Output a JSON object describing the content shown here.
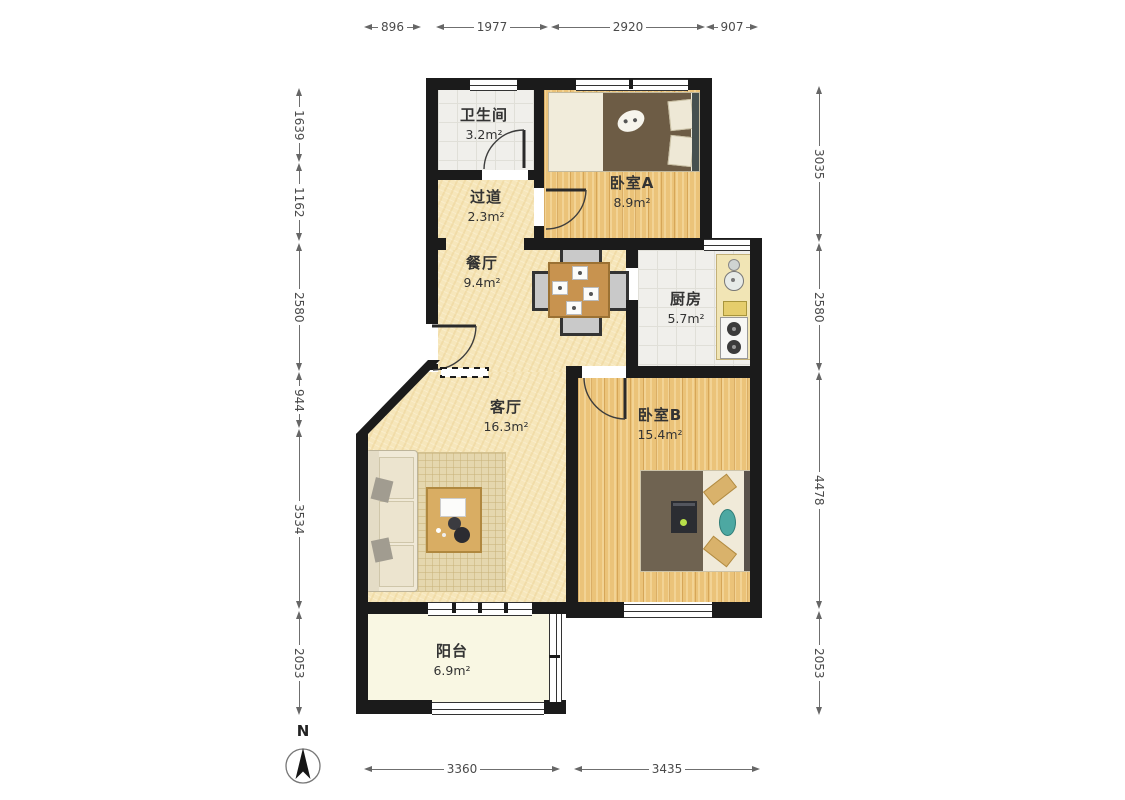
{
  "compass": {
    "label": "N"
  },
  "rooms": [
    {
      "name": "卫生间",
      "area": "3.2m²"
    },
    {
      "name": "过道",
      "area": "2.3m²"
    },
    {
      "name": "卧室A",
      "area": "8.9m²"
    },
    {
      "name": "餐厅",
      "area": "9.4m²"
    },
    {
      "name": "厨房",
      "area": "5.7m²"
    },
    {
      "name": "客厅",
      "area": "16.3m²"
    },
    {
      "name": "卧室B",
      "area": "15.4m²"
    },
    {
      "name": "阳台",
      "area": "6.9m²"
    }
  ],
  "dimensions": {
    "top": [
      "896",
      "1977",
      "2920",
      "907"
    ],
    "left": [
      "1639",
      "1162",
      "2580",
      "944",
      "3534",
      "2053"
    ],
    "right": [
      "3035",
      "2580",
      "4478",
      "2053"
    ],
    "bottom": [
      "3360",
      "3435"
    ]
  },
  "colors": {
    "wall": "#1b1b1b",
    "wood_floor": "#ebc379",
    "cream_floor": "#f6e6ba",
    "tile_floor": "#f0efeb",
    "balcony_floor": "#f9f7e3",
    "dimension_text": "#4a4a4a",
    "label_text": "#333333"
  }
}
